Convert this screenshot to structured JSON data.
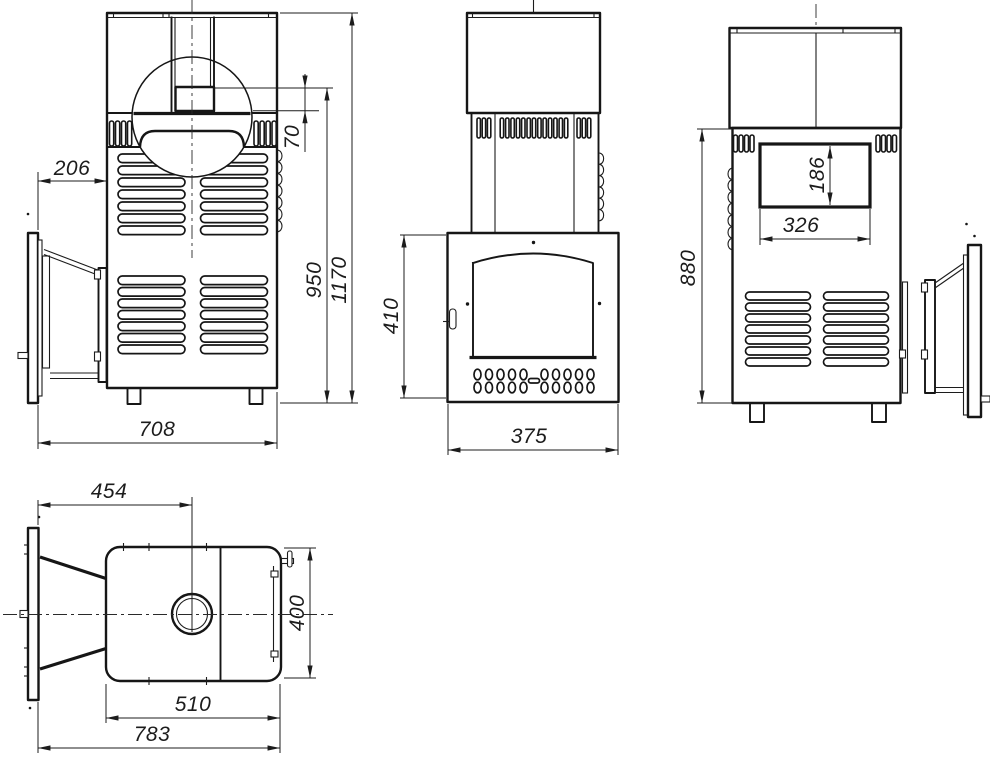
{
  "drawing": {
    "type": "technical-orthographic-views",
    "subject": "sauna-stove with external fuel tunnel",
    "views": [
      "side-left",
      "front",
      "rear",
      "top"
    ]
  },
  "dims": {
    "side_front_offset": "206",
    "side_width": "708",
    "chimney_step": "70",
    "body_height": "950",
    "total_height": "1170",
    "front_door_height": "410",
    "front_width": "375",
    "rear_opening_height": "186",
    "rear_opening_width": "326",
    "rear_height": "880",
    "top_tunnel_length": "454",
    "top_depth": "400",
    "top_body_width": "510",
    "top_total_width": "783"
  }
}
